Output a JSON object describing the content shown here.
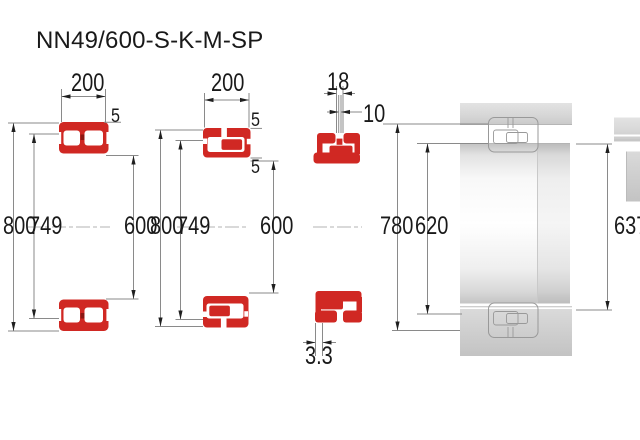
{
  "title": "NN49/600-S-K-M-SP",
  "diagrams": {
    "bearing1": {
      "width": "200",
      "flange": "5",
      "outer_diameter": "800",
      "rib_diameter": "749",
      "bore": "600"
    },
    "bearing2": {
      "width": "200",
      "flange_top": "5",
      "flange_mid": "5",
      "outer_diameter": "800",
      "rib_diameter": "749",
      "bore": "600"
    },
    "bearing3": {
      "groove_width": "18",
      "hole_diameter": "10",
      "raceway_diameter": "780",
      "inner_rib_diameter": "620",
      "taper_offset": "3.3"
    },
    "render": {
      "shoulder_diameter": "637"
    }
  },
  "colors": {
    "section_red": "#d02823",
    "cage_dark_red": "#8c1713",
    "dimension_line_grey": "#8a8a8a",
    "render_grey": "#d9d9d9",
    "text": "#191919",
    "background": "#ffffff"
  }
}
